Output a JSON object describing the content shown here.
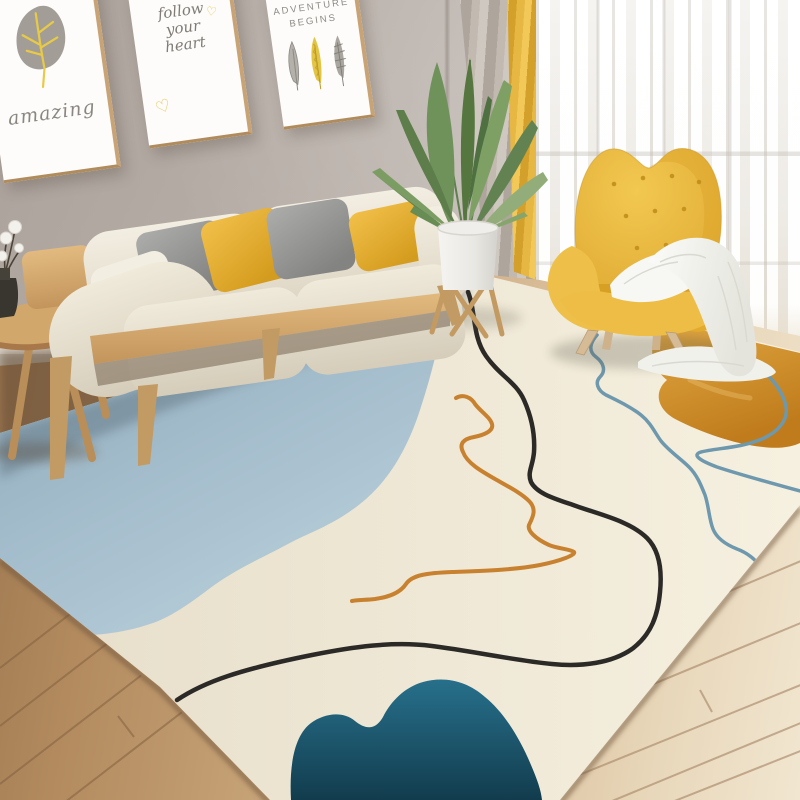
{
  "scene_title": "Scandinavian living room with abstract line-art area rug",
  "wall_art": {
    "frame1": {
      "icon": "leaf-icon",
      "word": "amazing"
    },
    "frame2": {
      "icon": "hearts-icon",
      "line1": "follow",
      "line2": "your",
      "line3": "heart",
      "heart_top": "♡",
      "heart_bottom": "♡"
    },
    "frame3": {
      "icon": "feathers-icon",
      "line1": "ADVENTURE",
      "line2": "BEGINS"
    }
  },
  "objects": {
    "sofa": "cream three-seat fabric sofa with light wood frame",
    "pillows": [
      "gray",
      "yellow",
      "gray",
      "yellow",
      "cream lumbar"
    ],
    "armchair": "mustard yellow tufted wingback chair with wood legs",
    "blanket": "white throw blanket draped over chair arm",
    "plant": "green leafy plant in white pot on wood stand",
    "side_table": "round wood side table with dark vase and cotton branches",
    "curtains": [
      "gray panel",
      "yellow panel",
      "white sheer"
    ],
    "rug": "cream abstract rug with light-blue field, teal and amber blobs and doodle lines",
    "floor": "light oak plank floor"
  },
  "palette": {
    "wall": "#bcb3ac",
    "floor_left": "#b28a5e",
    "floor_right": "#ecdcc2",
    "rug_cream": "#efe8d6",
    "rug_blue": "#a3bccb",
    "rug_teal": "#1b5a74",
    "rug_amber": "#d3922f",
    "line_black": "#2b2a27",
    "line_orange": "#c8812f",
    "line_blue": "#6d98ad",
    "sofa_cream": "#e9e2d2",
    "chair_yellow": "#e9b93e",
    "pillow_yellow": "#eab63a",
    "pillow_gray": "#97979a",
    "curtain_yellow": "#e3b246",
    "curtain_gray": "#b7aea6",
    "wood": "#c9a166"
  }
}
